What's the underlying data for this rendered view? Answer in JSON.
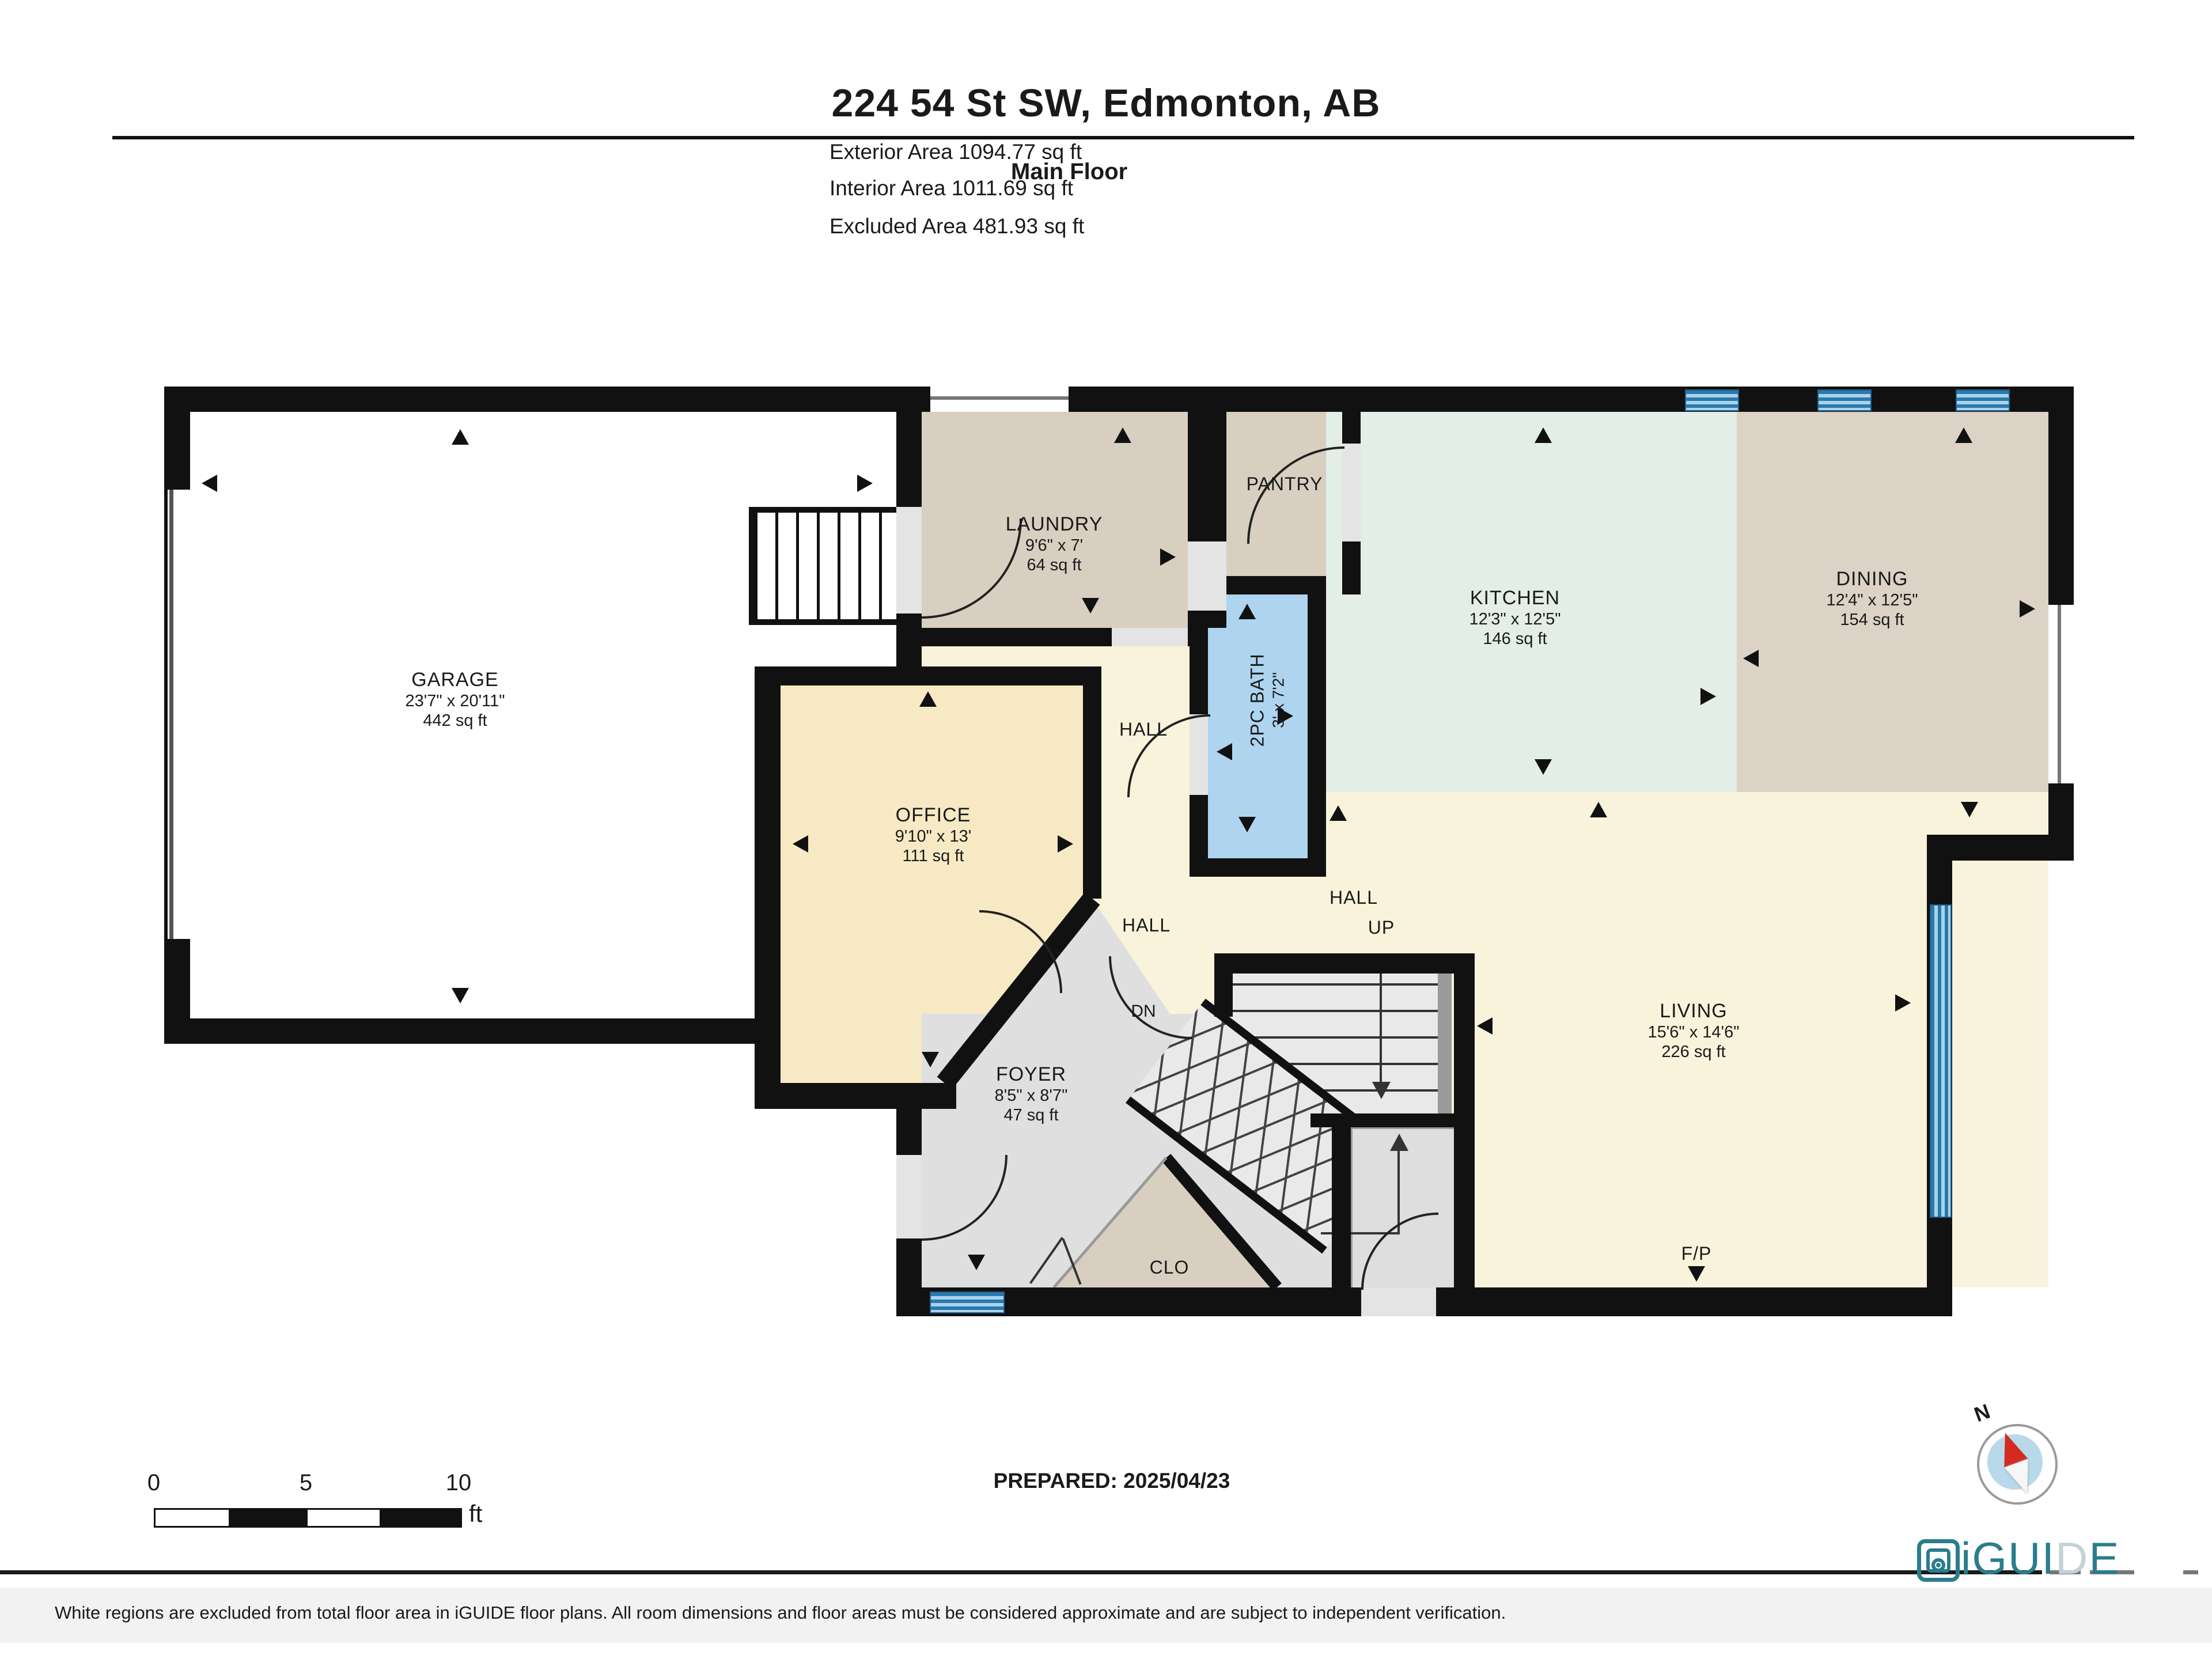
{
  "header": {
    "title": "224 54 St SW, Edmonton, AB",
    "floor_label": "Main Floor",
    "exterior_area": "Exterior Area 1094.77 sq ft",
    "interior_area": "Interior Area 1011.69 sq ft",
    "excluded_area": "Excluded Area 481.93 sq ft"
  },
  "rooms": {
    "garage": {
      "name": "GARAGE",
      "dims": "23'7\" x 20'11\"",
      "area": "442 sq ft"
    },
    "laundry": {
      "name": "LAUNDRY",
      "dims": "9'6\" x 7'",
      "area": "64 sq ft"
    },
    "pantry": {
      "name": "PANTRY"
    },
    "bath": {
      "name": "2PC BATH",
      "dims": "3' x 7'2\""
    },
    "kitchen": {
      "name": "KITCHEN",
      "dims": "12'3\" x 12'5\"",
      "area": "146 sq ft"
    },
    "dining": {
      "name": "DINING",
      "dims": "12'4\" x 12'5\"",
      "area": "154 sq ft"
    },
    "office": {
      "name": "OFFICE",
      "dims": "9'10\" x 13'",
      "area": "111 sq ft"
    },
    "living": {
      "name": "LIVING",
      "dims": "15'6\" x 14'6\"",
      "area": "226 sq ft"
    },
    "foyer": {
      "name": "FOYER",
      "dims": "8'5\" x 8'7\"",
      "area": "47 sq ft"
    },
    "closet": {
      "name": "CLO"
    },
    "hall_upper": {
      "name": "HALL"
    },
    "hall_center": {
      "name": "HALL"
    },
    "hall_lower": {
      "name": "HALL"
    },
    "up": {
      "name": "UP"
    },
    "down": {
      "name": "DN"
    },
    "fireplace": {
      "name": "F/P"
    }
  },
  "scale_bar": {
    "tick_0": "0",
    "tick_5": "5",
    "tick_10": "10",
    "unit": "ft"
  },
  "compass": {
    "north_label": "N"
  },
  "footer": {
    "prepared": "PREPARED: 2025/04/23",
    "disclaimer": "White regions are excluded from total floor area in iGUIDE floor plans. All room dimensions and floor areas must be considered approximate and are subject to independent verification.",
    "brand_prefix": "iGUI",
    "brand_d": "D",
    "brand_suffix": "E"
  },
  "colors": {
    "wall": "#111111",
    "cream": "#faf3dc",
    "tan": "#d9cfc1",
    "dining": "#dcd2c6",
    "office": "#f6e9c4",
    "kitchen": "#e3eee7",
    "bath": "#aed4ef",
    "foyer": "#dfdfdf",
    "garage": "#ffffff",
    "window_blue": "#5aabdd",
    "teal": "#2a7d8c",
    "compass_red": "#d42a20"
  }
}
